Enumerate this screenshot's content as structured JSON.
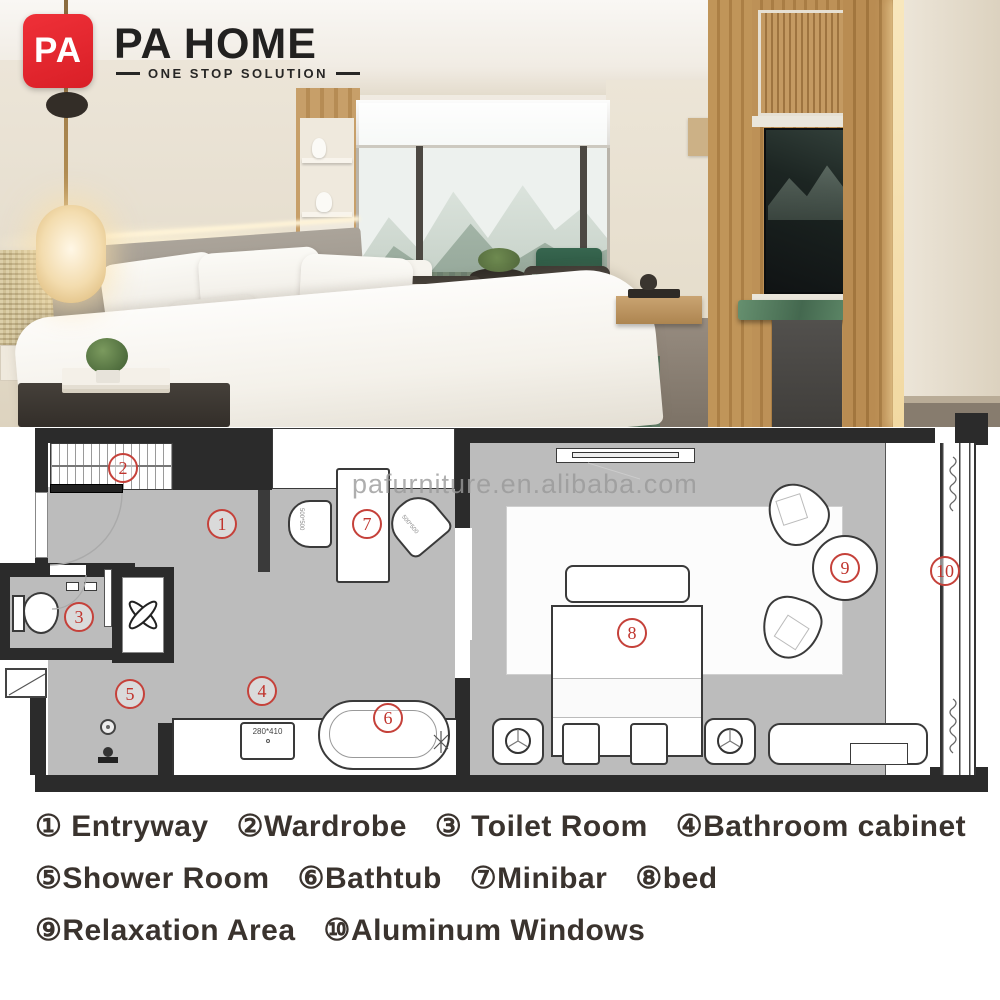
{
  "brand": {
    "logo_monogram": "PA",
    "name": "PA HOME",
    "tagline": "ONE STOP SOLUTION",
    "brand_red": "#e2242b"
  },
  "watermark": {
    "text": "pafurniture.en.alibaba.com"
  },
  "floorplan": {
    "badges": [
      "1",
      "2",
      "3",
      "4",
      "5",
      "6",
      "7",
      "8",
      "9",
      "10"
    ],
    "sink_size_label": "280*410",
    "minibar_chair_size_label": "500*500",
    "minibar_chair2_size_label": "500*500",
    "colors": {
      "wall": "#2b2b2b",
      "floor": "#bcbcbc",
      "badge_red": "#c0342d"
    }
  },
  "legend": {
    "rows": [
      [
        "① Entryway",
        "②Wardrobe",
        "③ Toilet Room",
        "④Bathroom cabinet"
      ],
      [
        "⑤Shower Room",
        "⑥Bathtub",
        "⑦Minibar",
        "⑧bed"
      ],
      [
        "⑨Relaxation Area",
        "⑩Aluminum Windows"
      ]
    ]
  }
}
